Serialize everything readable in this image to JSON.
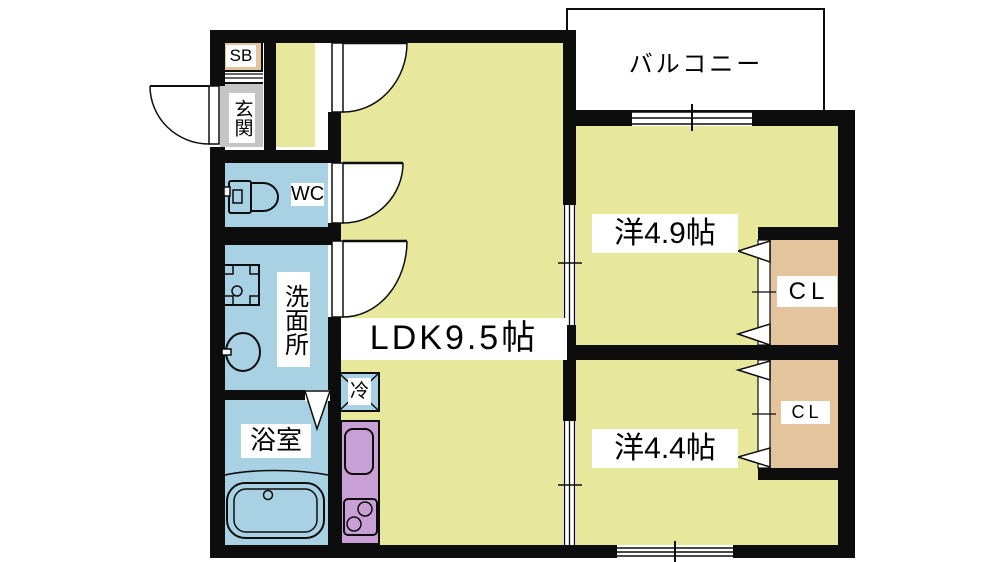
{
  "floorplan": {
    "rooms": {
      "balcony": {
        "label": "バルコニー"
      },
      "shoe_box": {
        "label": "SB"
      },
      "entrance": {
        "label": "玄関"
      },
      "toilet": {
        "label": "WC"
      },
      "washroom": {
        "label": "洗面所"
      },
      "bathroom": {
        "label": "浴室"
      },
      "ldk": {
        "label": "LDK9.5帖"
      },
      "western_room_1": {
        "label": "洋4.9帖"
      },
      "western_room_2": {
        "label": "洋4.4帖"
      },
      "closet_1": {
        "label": "CL"
      },
      "closet_2": {
        "label": "CL"
      },
      "refrigerator_space": {
        "label": "冷"
      }
    },
    "colors": {
      "room_yellow": "#e8e89c",
      "water_blue": "#a8d1e4",
      "kitchen_purple": "#c9a0d6",
      "closet_tan": "#e3c49d",
      "balcony_gray": "#c5c5c5",
      "wall_black": "#0d0d0d"
    },
    "fixtures": [
      "toilet-icon",
      "washing-machine-icon",
      "washbasin-icon",
      "bathtub-icon",
      "kitchen-sink-icon",
      "stove-icon",
      "refrigerator-icon",
      "hinged-door-icon",
      "folding-door-icon",
      "sliding-window-icon",
      "shoe-shelf-icon"
    ]
  }
}
